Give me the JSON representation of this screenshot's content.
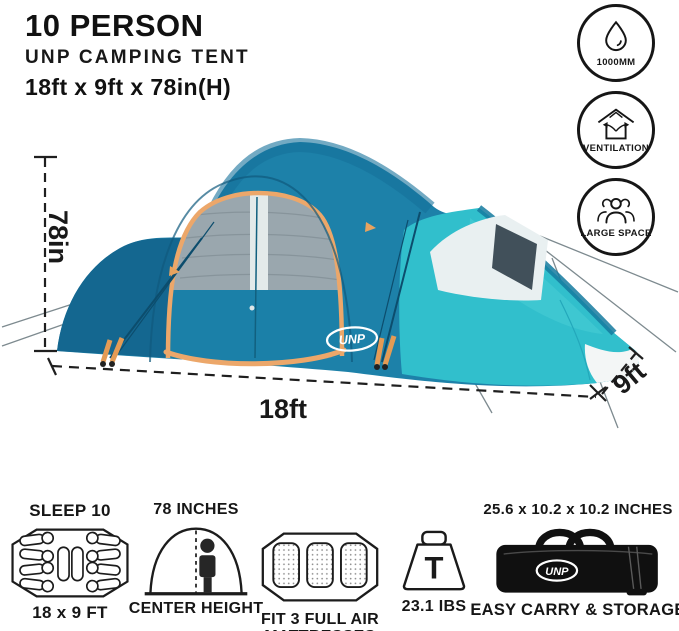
{
  "header": {
    "title": "10 PERSON",
    "subtitle": "UNP CAMPING TENT",
    "size_line": "18ft x 9ft x 78in(H)"
  },
  "badges": [
    {
      "icon": "water-drop-icon",
      "label": "1000MM"
    },
    {
      "icon": "ventilation-icon",
      "label": "VENTILATION"
    },
    {
      "icon": "people-icon",
      "label": "LARGE SPACE"
    }
  ],
  "tent": {
    "logo_text": "UNP",
    "height_label": "78in",
    "length_label": "18ft",
    "width_label": "9ft"
  },
  "features": {
    "sleep": {
      "title": "SLEEP 10",
      "caption": "18 x 9 FT"
    },
    "height": {
      "title": "78 INCHES",
      "caption": "CENTER HEIGHT"
    },
    "mattress": {
      "caption_line1": "FIT 3 FULL AIR",
      "caption_line2": "MATTRESSES"
    },
    "weight": {
      "glyph": "T",
      "caption": "23.1 IBS"
    },
    "storage": {
      "title": "25.6 x 10.2 x 10.2 INCHES",
      "caption": "EASY CARRY & STORAGE",
      "bag_logo": "UNP"
    }
  },
  "colors": {
    "tent_teal_dark": "#14648d",
    "tent_teal_mid": "#1d81a9",
    "tent_turquoise": "#31bfcc",
    "trim_orange": "#eca76a",
    "mesh_gray": "#9aa7ae",
    "ink": "#161616"
  }
}
